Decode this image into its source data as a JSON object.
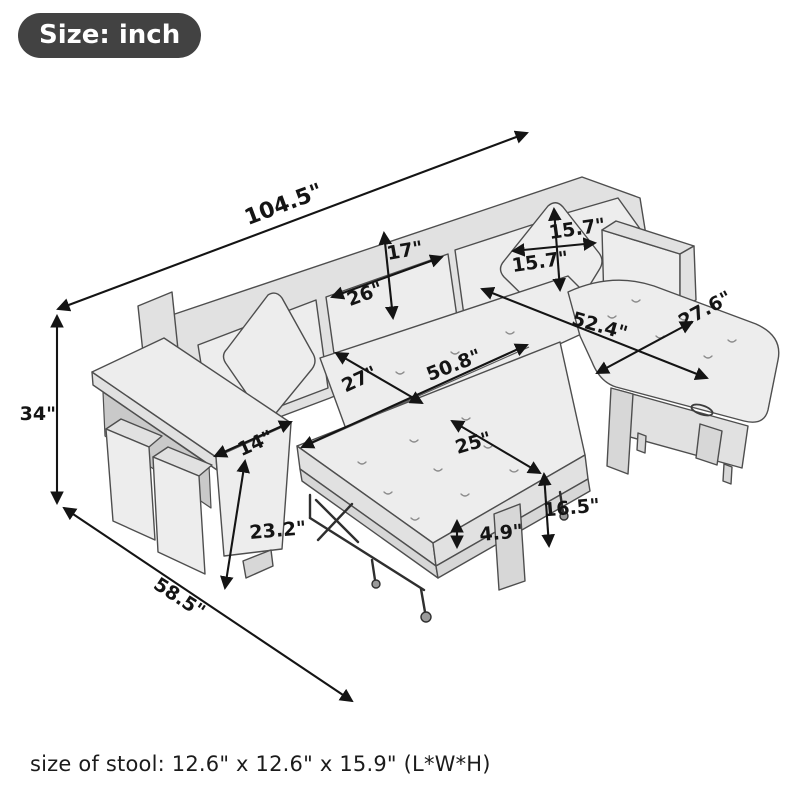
{
  "badge": {
    "label": "Size: inch"
  },
  "footer": {
    "stool_size": "size of stool: 12.6\" x 12.6\" x 15.9\" (L*W*H)"
  },
  "diagram": {
    "type": "product-dimension-diagram",
    "subject": "L-shaped sectional sleeper sofa with pull-out bed, storage chaise and two stools",
    "unit": "inch",
    "dimensions": [
      {
        "name": "overall-length",
        "value": "104.5\""
      },
      {
        "name": "overall-height",
        "value": "34\""
      },
      {
        "name": "overall-depth",
        "value": "58.5\""
      },
      {
        "name": "back-cushion-height",
        "value": "17\""
      },
      {
        "name": "back-cushion-width",
        "value": "26\""
      },
      {
        "name": "pillow-height",
        "value": "15.7\""
      },
      {
        "name": "pillow-width",
        "value": "15.7\""
      },
      {
        "name": "chaise-length",
        "value": "52.4\""
      },
      {
        "name": "chaise-width",
        "value": "27.6\""
      },
      {
        "name": "sleeper-length",
        "value": "50.8\""
      },
      {
        "name": "seat-depth",
        "value": "27\""
      },
      {
        "name": "sleeper-width",
        "value": "25\""
      },
      {
        "name": "sleeper-height",
        "value": "16.5\""
      },
      {
        "name": "frame-height",
        "value": "4.9\""
      },
      {
        "name": "armrest-width",
        "value": "14\""
      },
      {
        "name": "armrest-height",
        "value": "23.2\""
      }
    ]
  }
}
